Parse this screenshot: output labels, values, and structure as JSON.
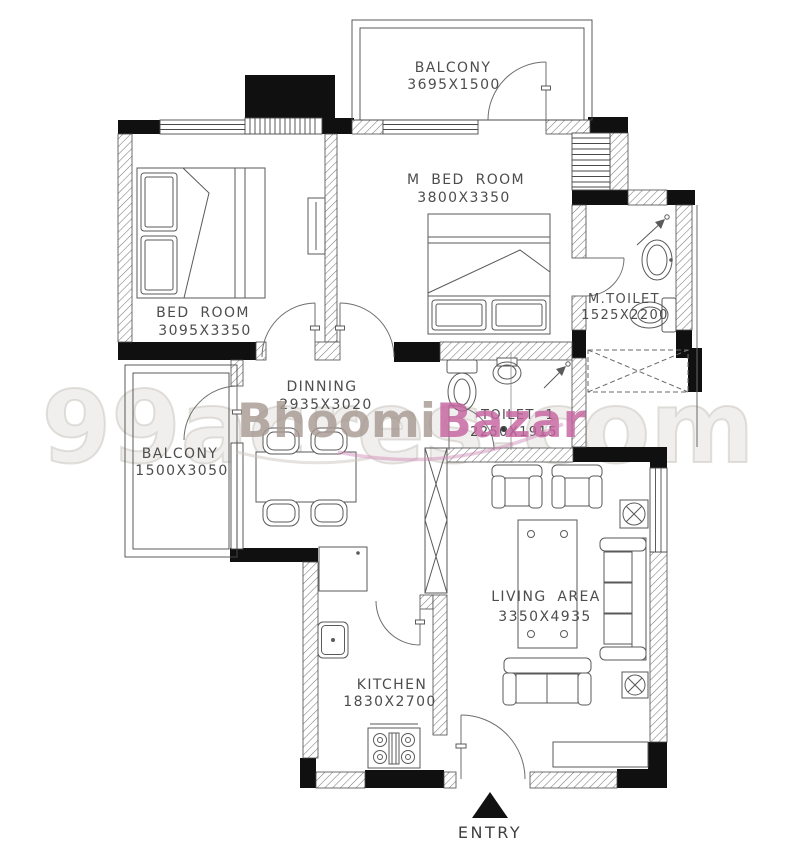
{
  "watermark": {
    "brand_first": "Bhoomi",
    "brand_second": "Bazar",
    "brand_first_color": "#a89a93",
    "brand_second_color": "#c6659f",
    "ghost": "99acres.com"
  },
  "entry": {
    "label": "ENTRY"
  },
  "rooms": {
    "balcony_top": {
      "name": "BALCONY",
      "dim": "3695X1500"
    },
    "bed_room": {
      "name": "BED ROOM",
      "dim": "3095X3350"
    },
    "m_bed_room": {
      "name": "M BED ROOM",
      "dim": "3800X3350"
    },
    "m_toilet": {
      "name": "M.TOILET",
      "dim": "1525X2200"
    },
    "dinning": {
      "name": "DINNING",
      "dim": "2935X3020"
    },
    "toilet_1": {
      "name": "TOILET 1",
      "dim": "2250X1915"
    },
    "balcony_left": {
      "name": "BALCONY",
      "dim": "1500X3050"
    },
    "living_area": {
      "name": "LIVING AREA",
      "dim": "3350X4935"
    },
    "kitchen": {
      "name": "KITCHEN",
      "dim": "1830X2700"
    }
  },
  "colors": {
    "wall": "#101010",
    "line": "#4a4a4a",
    "text": "#4d4d4d"
  }
}
